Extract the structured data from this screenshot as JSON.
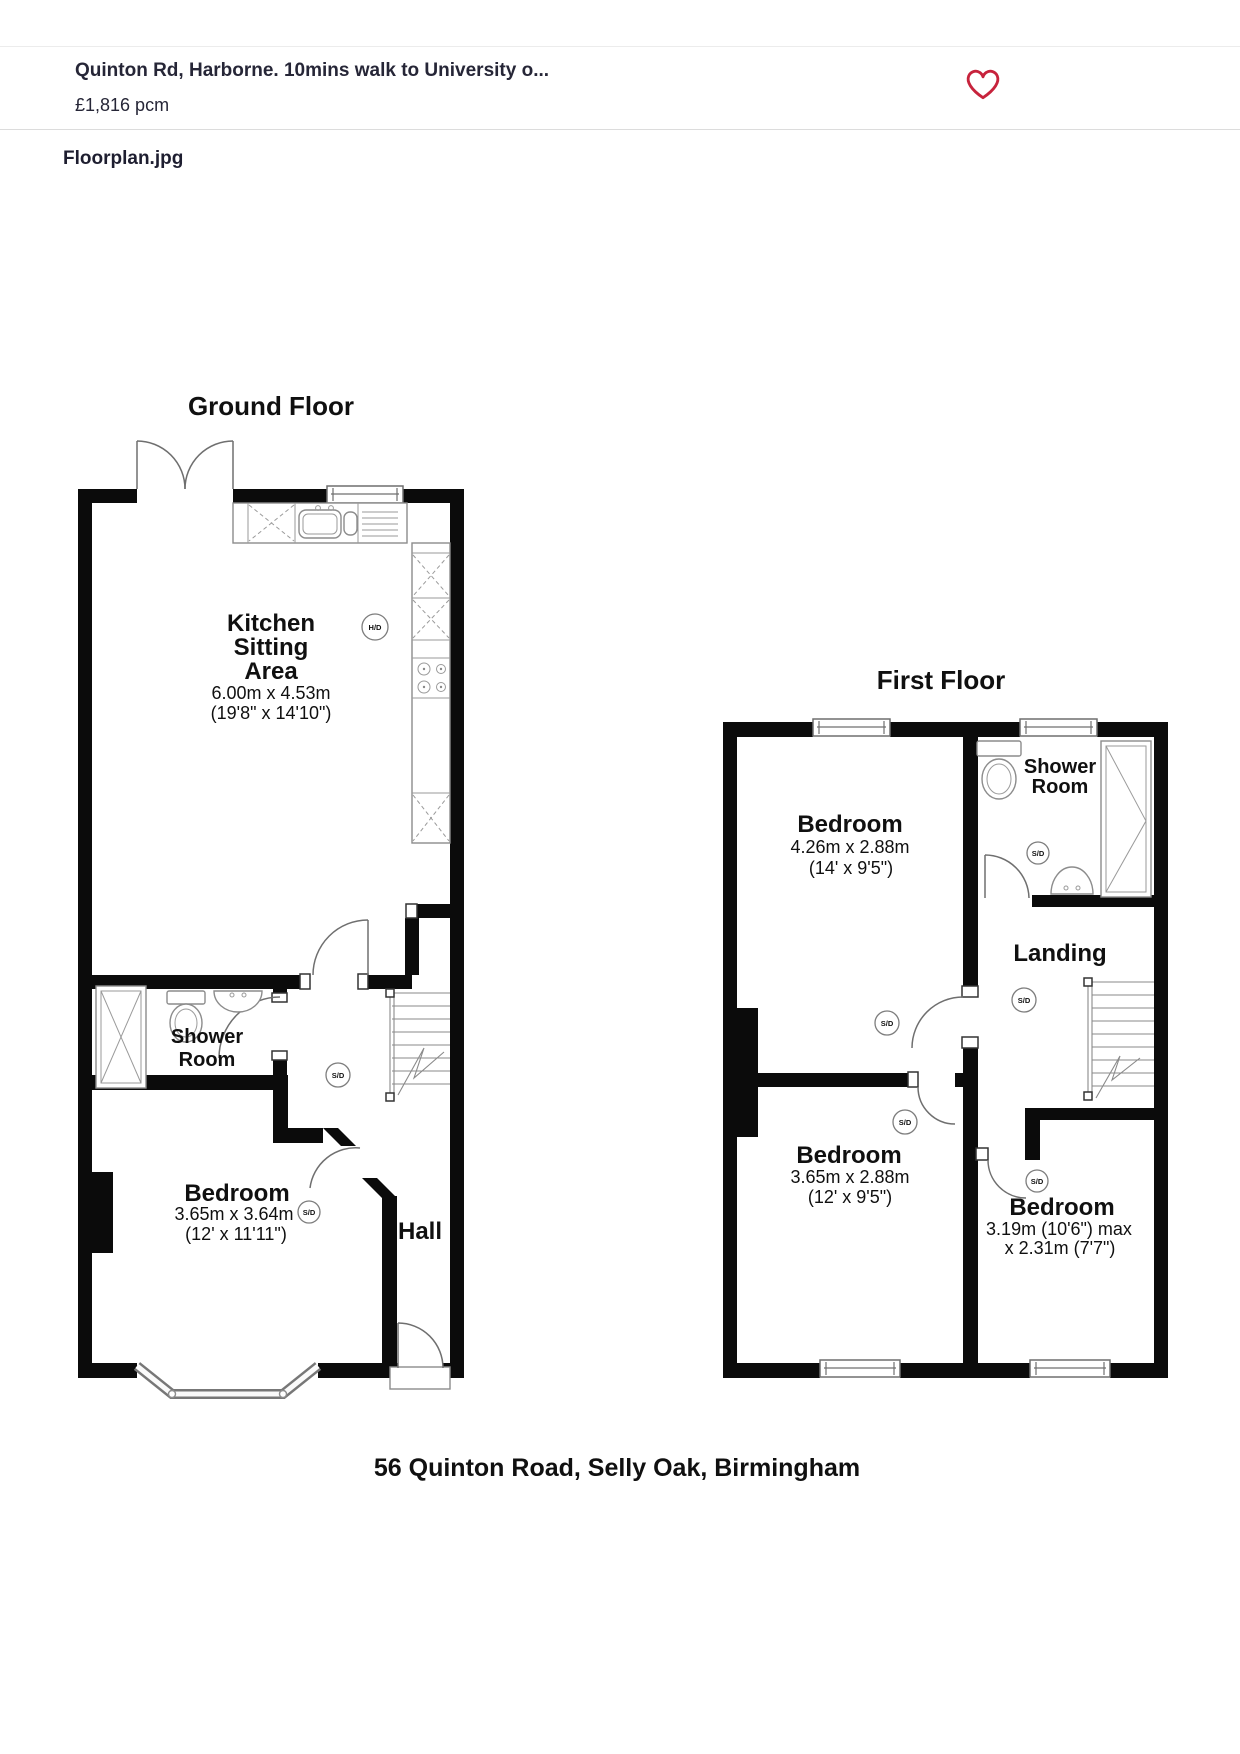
{
  "header": {
    "listing_title": "Quinton Rd, Harborne. 10mins walk to University o...",
    "price": "£1,816 pcm",
    "favourite_icon": "heart-outline-icon",
    "favourite_color": "#c7233c"
  },
  "gallery": {
    "filename_label": "Floorplan.jpg"
  },
  "floorplan": {
    "caption": "56 Quinton Road, Selly Oak, Birmingham",
    "markers": {
      "smoke_detector": "S/D",
      "heat_detector": "H/D"
    },
    "ground_floor": {
      "title": "Ground Floor",
      "kitchen": {
        "line1": "Kitchen",
        "line2": "Sitting",
        "line3": "Area",
        "dims_metric": "6.00m x 4.53m",
        "dims_imperial": "(19'8\" x 14'10\")"
      },
      "shower_room": {
        "line1": "Shower",
        "line2": "Room"
      },
      "bedroom": {
        "name": "Bedroom",
        "dims_metric": "3.65m x 3.64m",
        "dims_imperial": "(12' x 11'11\")"
      },
      "hall": {
        "name": "Hall"
      }
    },
    "first_floor": {
      "title": "First Floor",
      "bedroom_front": {
        "name": "Bedroom",
        "dims_metric": "4.26m x 2.88m",
        "dims_imperial": "(14' x 9'5\")"
      },
      "shower_room": {
        "line1": "Shower",
        "line2": "Room"
      },
      "landing": {
        "name": "Landing"
      },
      "bedroom_middle": {
        "name": "Bedroom",
        "dims_metric": "3.65m x 2.88m",
        "dims_imperial": "(12' x 9'5\")"
      },
      "bedroom_rear": {
        "name": "Bedroom",
        "dims_line1": "3.19m (10'6\") max",
        "dims_line2": "x 2.31m (7'7\")"
      }
    }
  }
}
